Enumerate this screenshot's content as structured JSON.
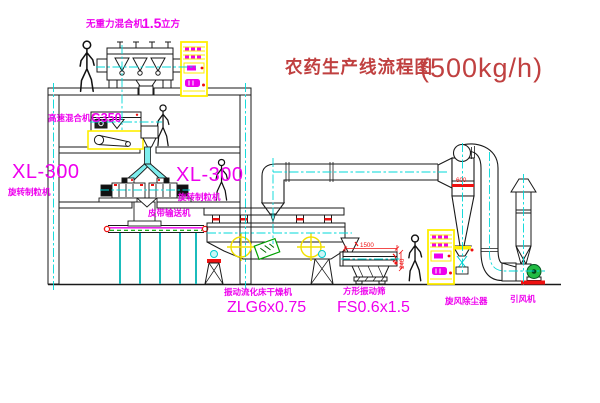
{
  "title": {
    "text": "农药生产线流程图",
    "capacity": "(500kg/h)"
  },
  "labels": {
    "gravity_mixer_name": "无重力混合机",
    "gravity_mixer_size": "1.5",
    "gravity_mixer_unit": "立方",
    "high_speed_mixer_name": "高速混合机",
    "high_speed_mixer_model": "G350",
    "granulator_left_model": "XL-300",
    "granulator_left_name": "旋转制粒机",
    "granulator_right_model": "XL-300",
    "granulator_right_name": "旋转制粒机",
    "belt_conveyor": "皮带输送机",
    "dryer_name": "振动流化床干燥机",
    "dryer_model": "ZLG6x0.75",
    "sieve_name": "方形振动筛",
    "sieve_model": "FS0.6x1.5",
    "cyclone_name": "旋风除尘器",
    "fan_name": "引风机"
  },
  "dimensions": {
    "sieve_length": "1500",
    "sieve_height": "340",
    "cyclone_body": "600"
  },
  "colors": {
    "label_magenta": "#ee00ee",
    "title_red": "#c04040",
    "centerline_cyan": "#00d8d8",
    "highlight_yellow": "#ffee00",
    "accent_red": "#ee1111",
    "fan_green": "#22bb44",
    "stream_cyan": "#7deeee",
    "line_black": "#1a1a1a"
  }
}
